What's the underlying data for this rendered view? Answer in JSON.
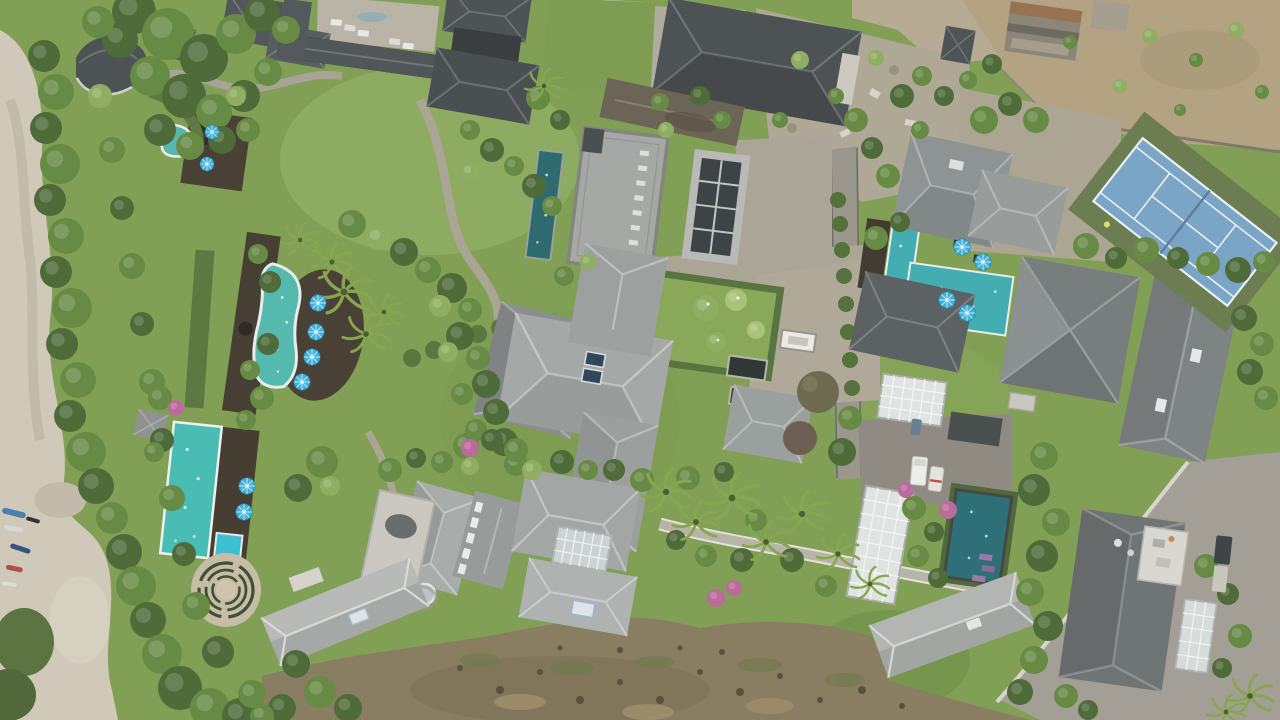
{
  "meta": {
    "title": "Aerial drone view of a tropical villa resort",
    "alt": "Top-down drone photograph of a luxury tropical villa estate: clusters of gray hip roofs, turquoise swimming pools with blue sun umbrellas, manicured lawns and hedged gardens, palm trees, a blue tennis court at the upper right, a sandy beach path with small boats along the left edge, dry scrubland along the bottom and upper-right corner"
  },
  "palette": {
    "lawn": "#82a055",
    "lawn_bright": "#93b168",
    "foliage_dark": "#4e6b39",
    "foliage_mid": "#678a44",
    "sand": "#d0c9b9",
    "dirt_scrub": "#8a7e62",
    "dry_field": "#b3a383",
    "stone_path": "#aba595",
    "asphalt": "#8f8b83",
    "roof_dark": "#4e5356",
    "roof_mid": "#8e9393",
    "roof_light": "#aeb2b0",
    "roof_flat_speckled": "#a6a8a5",
    "pool_turquoise": "#4fbdb4",
    "pool_teal": "#2e6b70",
    "pool_dark_green": "#3a6152",
    "tennis_court_blue": "#7aa5c7",
    "tennis_surround": "#6c7d52",
    "tennis_lines": "#e9eff3",
    "umbrella_blue": "#3fb2da",
    "wood_deck": "#473f33",
    "glass_pergola": "#dfe3e1"
  },
  "scene": {
    "type": "aerial-drone-photo",
    "orientation": "top-down",
    "features": [
      "fan-shaped shell roof pavilion at upper left",
      "kidney-shaped pool with curved timber deck and four blue umbrellas",
      "rectangular lap pool with deck, two umbrellas and a blue day-bed",
      "spiral landscaped circle near the cliff edge",
      "long dark-green lap pool at top center",
      "large speckled flat roof with skylight row",
      "dark glass-panel roof pavilion",
      "large cross-shaped pale hip roof villa with two solar skylights",
      "hedged courtyard lawns with frangipani trees and dark reflecting ponds",
      "L-shaped turquoise pool with four blue umbrellas",
      "white glass pergolas",
      "blue hard tennis court with olive surround",
      "beach path with small boats at the lower left",
      "palm-lined stone walkway",
      "dark teal plunge pool with purple loungers",
      "driveways with white van, cars and a truck with trailer",
      "parking courtyard with four white cars at top",
      "rubble construction lot and shacks at top right",
      "dry scrub field in the upper-right corner",
      "brown rocky scrubland across the bottom"
    ],
    "counts": {
      "swimming_pools": 7,
      "sun_umbrellas": 12,
      "tennis_courts": 1,
      "glass_pergolas": 4,
      "vehicles": 8,
      "beached_boats": 5,
      "villa_roofs": 25
    }
  }
}
